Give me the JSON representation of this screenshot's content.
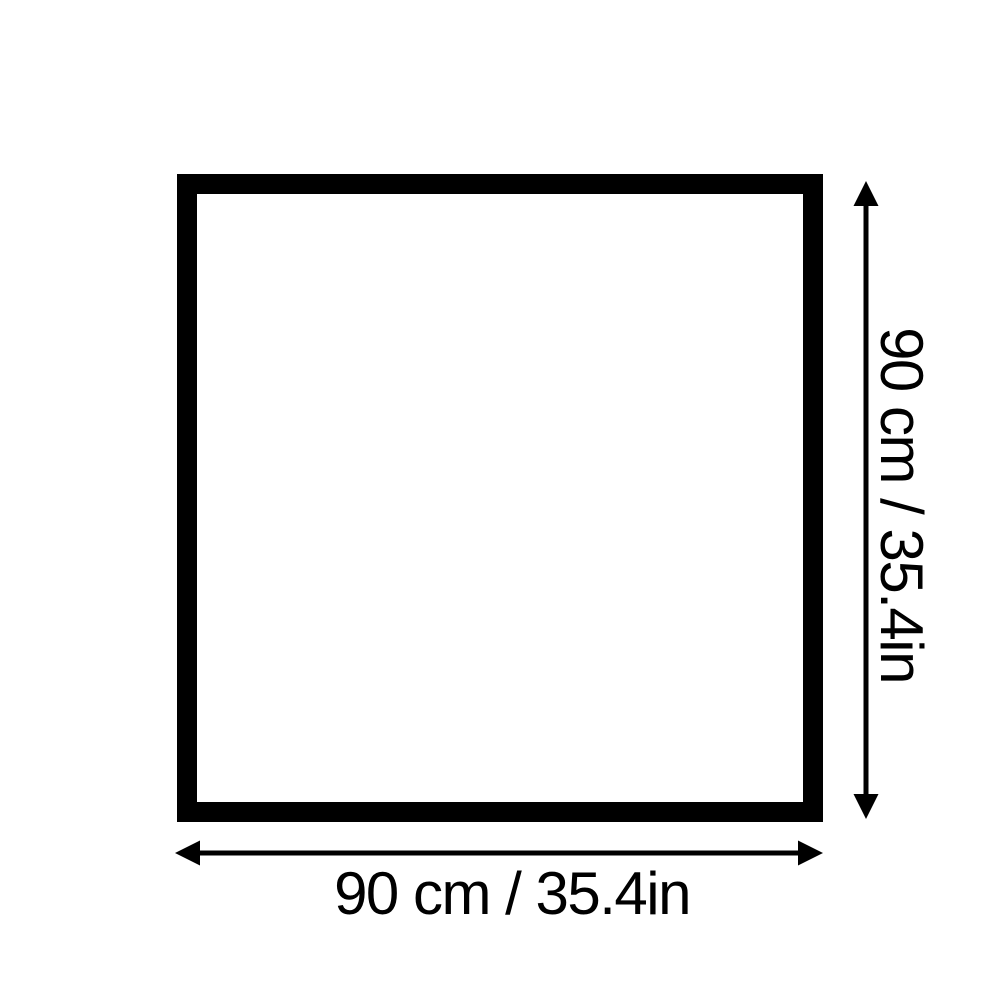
{
  "page": {
    "background_color": "#ffffff"
  },
  "diagram": {
    "shape": "square-outline",
    "line_color": "#000000",
    "width_dimension": {
      "label": "90 cm / 35.4in"
    },
    "height_dimension": {
      "label": "90 cm / 35.4in"
    }
  }
}
